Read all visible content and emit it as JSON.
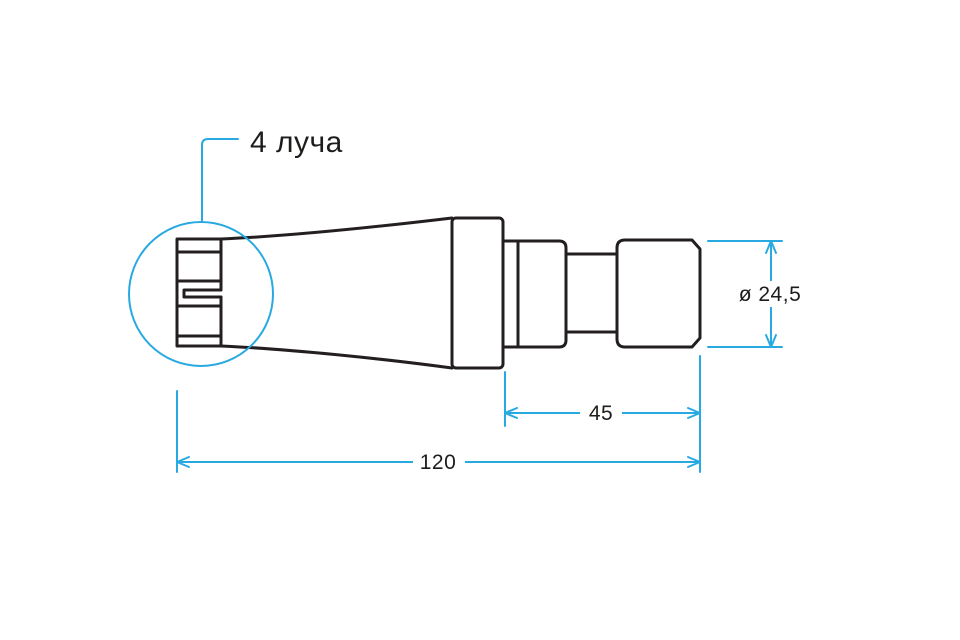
{
  "page": {
    "background": "#ffffff"
  },
  "colors": {
    "outline": "#231f20",
    "dimension": "#29a9e1",
    "text": "#1d1d1b"
  },
  "callout": {
    "label": "4 луча"
  },
  "dimensions": {
    "diameter": {
      "label": "ø 24,5",
      "value": 24.5
    },
    "front_length": {
      "label": "45",
      "value": 45
    },
    "overall_length": {
      "label": "120",
      "value": 120
    }
  }
}
